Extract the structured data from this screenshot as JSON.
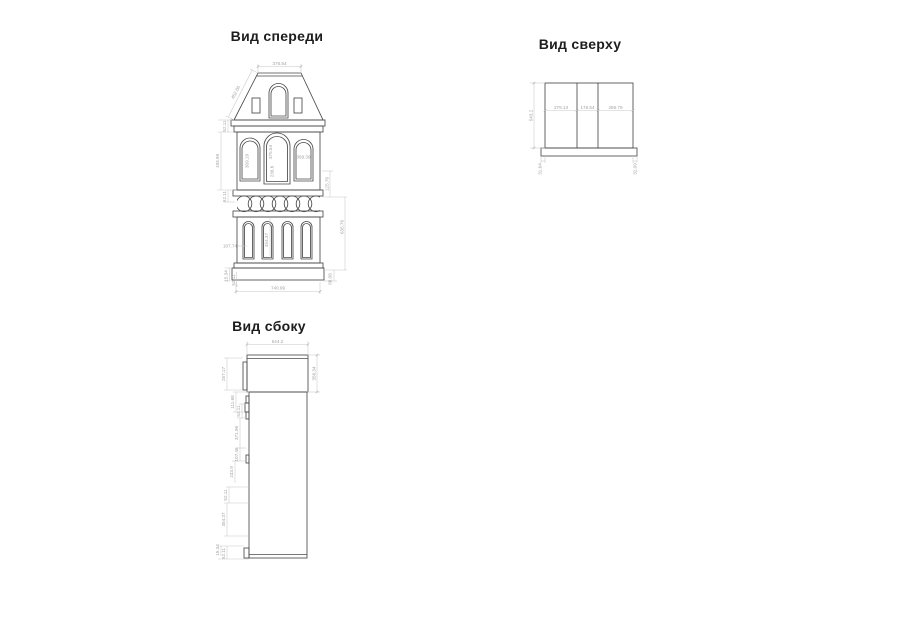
{
  "document": {
    "type": "technical-drawing",
    "language": "ru"
  },
  "colors": {
    "background": "#ffffff",
    "geometry_line": "#4a4a4a",
    "dimension_line": "#c7c7c7",
    "dimension_text": "#a3a3a3",
    "title_text": "#1d1d1d"
  },
  "views": {
    "front": {
      "title": "Вид спереди",
      "dim_top_width": "376.54",
      "dim_roof_slope": "452.66",
      "dim_left_cornice": "52.11",
      "dim_left_body": "193.99",
      "dim_left_band": "52.11",
      "dim_window_left": "309.19",
      "dim_window_mid_height": "375.54",
      "dim_window_mid_width": "236.6",
      "dim_window_right": "369.39",
      "dim_lower_window": "107.74",
      "dim_lower_body": "454.37",
      "dim_right_band": "125.76",
      "dim_right_lower": "635.76",
      "dim_right_base": "88.08",
      "dim_bottom_width": "740.99",
      "dim_base_small": "15.34",
      "dim_base_large": "52.11"
    },
    "top": {
      "title": "Вид сверху",
      "dim_depth": "543.2",
      "dim_panel_1": "279.13",
      "dim_panel_2": "176.54",
      "dim_panel_3": "286.79",
      "dim_overhang_left": "31.64",
      "dim_overhang_right": "32.09"
    },
    "side": {
      "title": "Вид сбоку",
      "dim_top_width": "544.2",
      "dim_right_height": "356.34",
      "ladder": [
        "257.17",
        "111.68",
        "52.11",
        "371.96",
        "107.48",
        "233.9",
        "52.11",
        "454.37",
        "15.34",
        "52.11"
      ]
    }
  }
}
